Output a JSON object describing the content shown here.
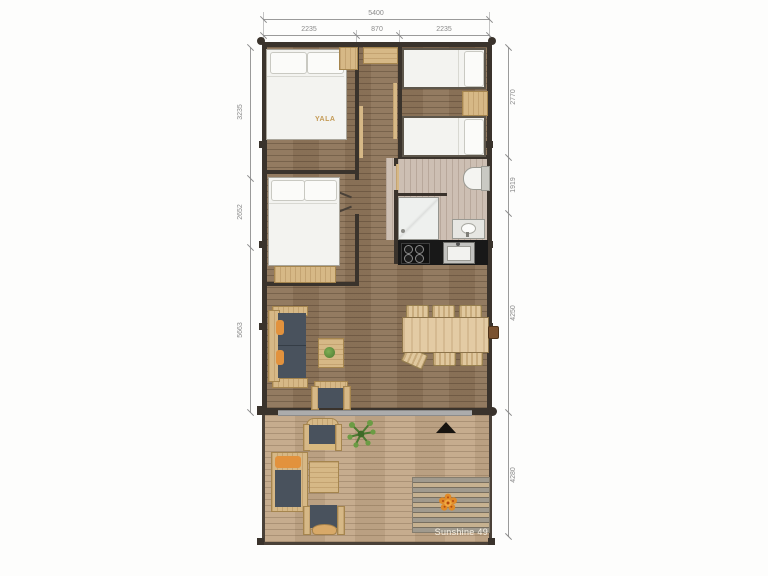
{
  "plan": {
    "name": "Sunshine 49",
    "brand": "YALA"
  },
  "dimensions": {
    "top": {
      "total": "5400",
      "segments": [
        "2235",
        "870",
        "2235"
      ]
    },
    "left": {
      "segments": [
        "3235",
        "2652",
        "5663"
      ]
    },
    "right": {
      "segments": [
        "2770",
        "1919",
        "4250",
        "4280"
      ]
    }
  },
  "colors": {
    "wall": "#3a332c",
    "floor_wood": "#8d7459",
    "floor_bathroom": "#cdbfb3",
    "deck_wood": "#c2a787",
    "counter_black": "#181818",
    "light_wood": "#d6b886",
    "cushion_dark": "#49525d",
    "accent_orange": "#e2923d",
    "brand_gold": "#c49a55",
    "dimension_grey": "#8a8a8a"
  }
}
